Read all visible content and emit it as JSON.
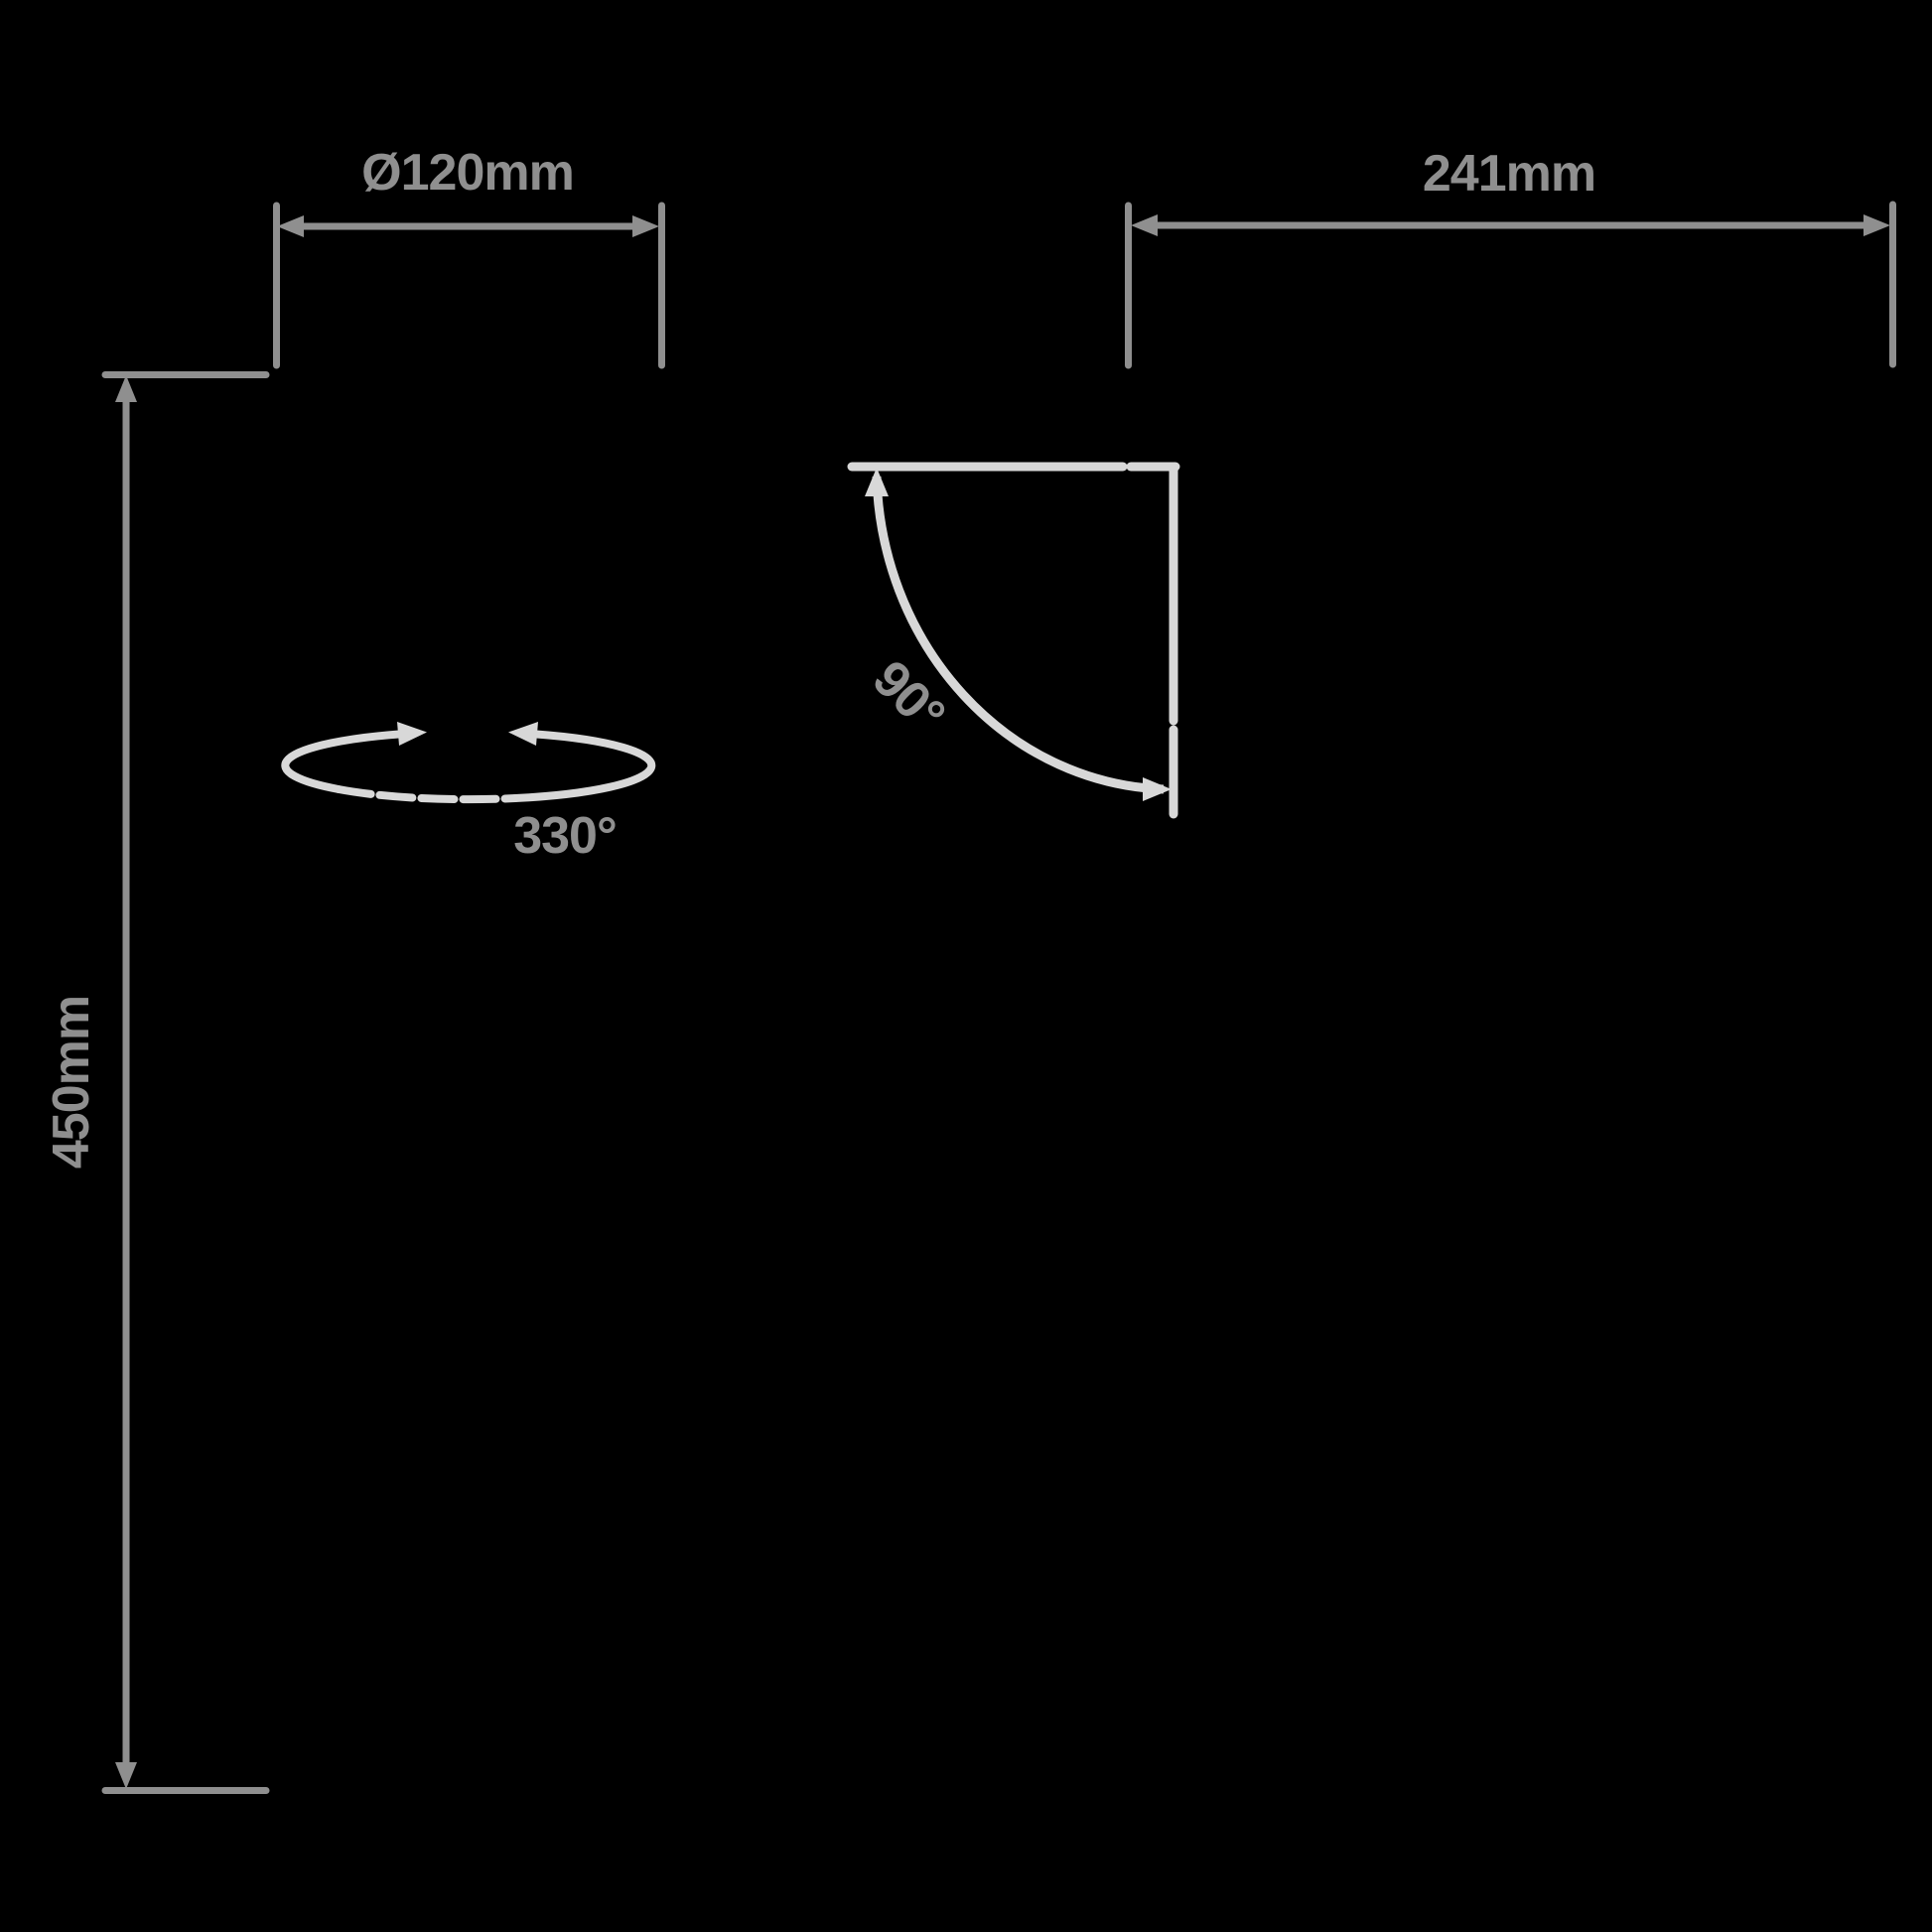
{
  "page": {
    "background": "#000000"
  },
  "diagram": {
    "type": "product-dimension-drawing",
    "colors": {
      "dimension_lines_and_text": "#8f8f8f",
      "motion_arcs": "#d8d8d8"
    },
    "dimensions": {
      "diameter": "Ø120mm",
      "width": "241mm",
      "height": "450mm",
      "rotation": "330°",
      "tilt": "90°"
    }
  }
}
